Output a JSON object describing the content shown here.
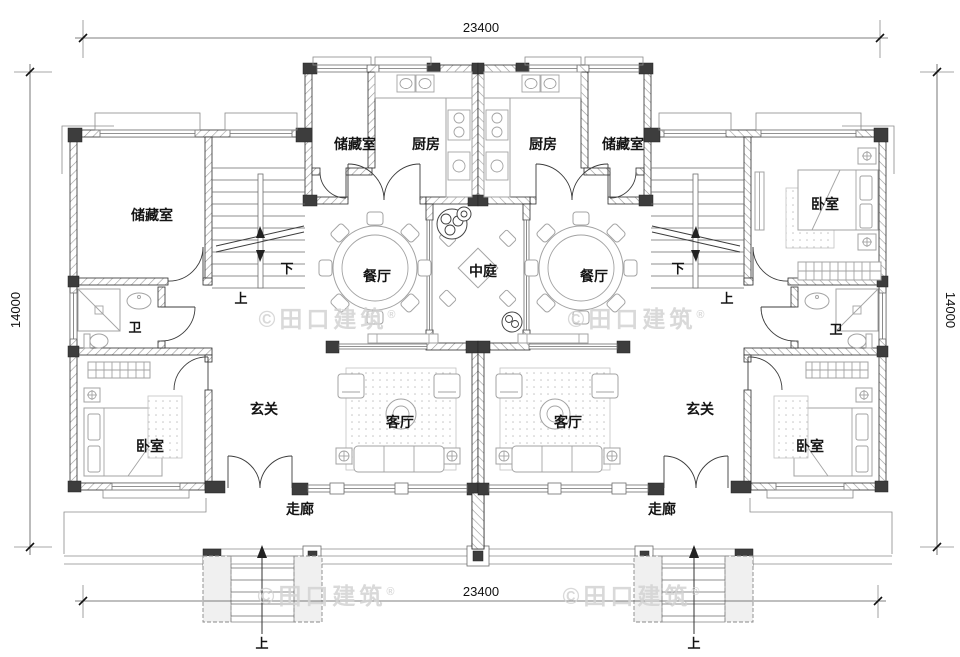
{
  "dimensions": {
    "top": "23400",
    "bottom": "23400",
    "left": "14000",
    "right": "14000"
  },
  "room_labels": {
    "storage": "储藏室",
    "kitchen": "厨房",
    "dining": "餐厅",
    "atrium": "中庭",
    "foyer": "玄关",
    "living": "客厅",
    "bedroom": "卧室",
    "bath": "卫",
    "corridor": "走廊"
  },
  "stair_labels": {
    "up": "上",
    "down": "下"
  },
  "watermark": {
    "copyright": "©田口建筑",
    "registered": "®"
  },
  "colors": {
    "wall_fill": "#3d3d3d",
    "hatch": "#9a9a9a",
    "furniture": "#a3a3a3",
    "watermark": "#d3d3d3"
  }
}
